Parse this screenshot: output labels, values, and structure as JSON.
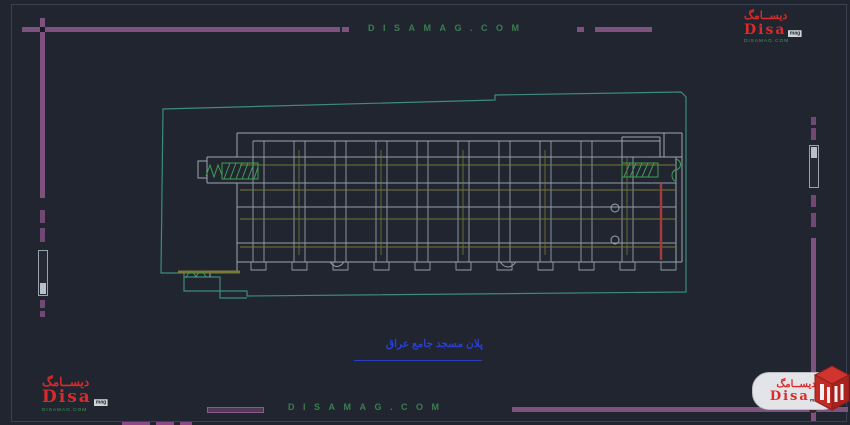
{
  "watermark": {
    "top": "DISAMAG.COM",
    "bottom": "DISAMAG.COM"
  },
  "caption": {
    "text": "پلان مسجد جامع عراق"
  },
  "logo": {
    "arabic": "دیســامگ",
    "name": "Disa",
    "suffix": "mag",
    "site": "DISAMAG.COM"
  },
  "colors": {
    "background": "#20252f",
    "border_purple": "#7d527f",
    "site_boundary_teal": "#3d8a82",
    "building_gray": "#9ca6b0",
    "grid_olive": "#7d7d35",
    "hatch_green": "#3f9e54",
    "watermark_green": "#3f8a55",
    "caption_blue": "#2b3fd0",
    "accent_red": "#a23c3c",
    "logo_red": "#d92b2b"
  }
}
